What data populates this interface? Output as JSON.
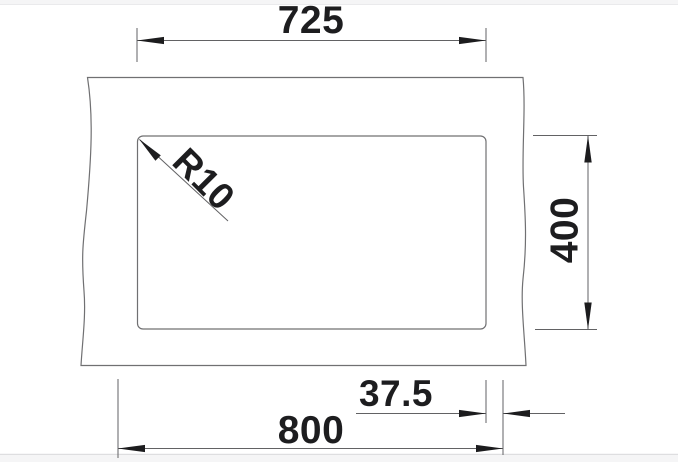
{
  "drawing": {
    "dimensions": {
      "cutout_width": "725",
      "cutout_depth": "400",
      "edge_offset": "37.5",
      "overall_width": "800",
      "corner_radius": "R10"
    },
    "colors": {
      "background": "#ffffff",
      "band": "#f5f5f6",
      "band_edge_top": "#eaeaec",
      "band_edge_bottom": "#d8d8da",
      "outline": "#707072",
      "dimension": "#626264",
      "arrow": "#1c1c1e",
      "text": "#1d1d1f"
    }
  }
}
